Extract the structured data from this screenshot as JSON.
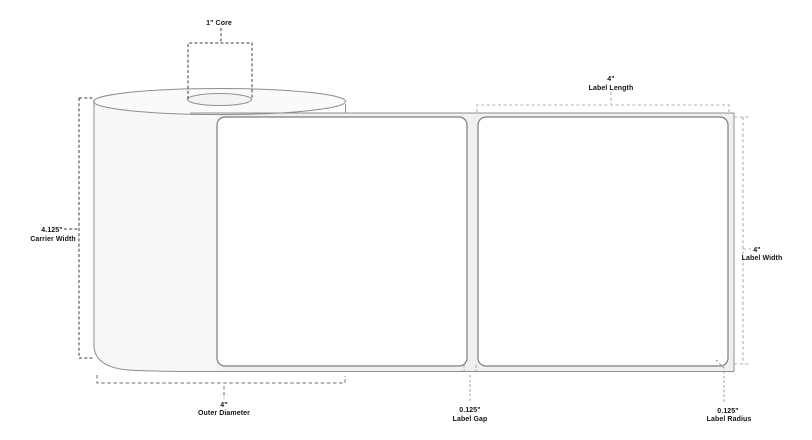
{
  "diagram": {
    "description": "Label roll dimension specification diagram",
    "annotations": {
      "core": {
        "label": "1\" Core"
      },
      "label_length": {
        "value": "4\"",
        "name": "Label Length"
      },
      "carrier_width": {
        "value": "4.125\"",
        "name": "Carrier Width"
      },
      "label_width": {
        "value": "4\"",
        "name": "Label Width"
      },
      "outer_diameter": {
        "value": "4\"",
        "name": "Outer Diameter"
      },
      "label_gap": {
        "value": "0.125\"",
        "name": "Label Gap"
      },
      "label_radius": {
        "value": "0.125\"",
        "name": "Label Radius"
      }
    },
    "colors": {
      "outline": "#8f8f8f",
      "roll_fill": "#f7f7f7",
      "liner_fill": "#f0f0f0",
      "label_fill": "#ffffff",
      "dimension_dark": "#3d3d3d",
      "dimension_light": "#b0b0b0",
      "text": "#141414"
    }
  }
}
